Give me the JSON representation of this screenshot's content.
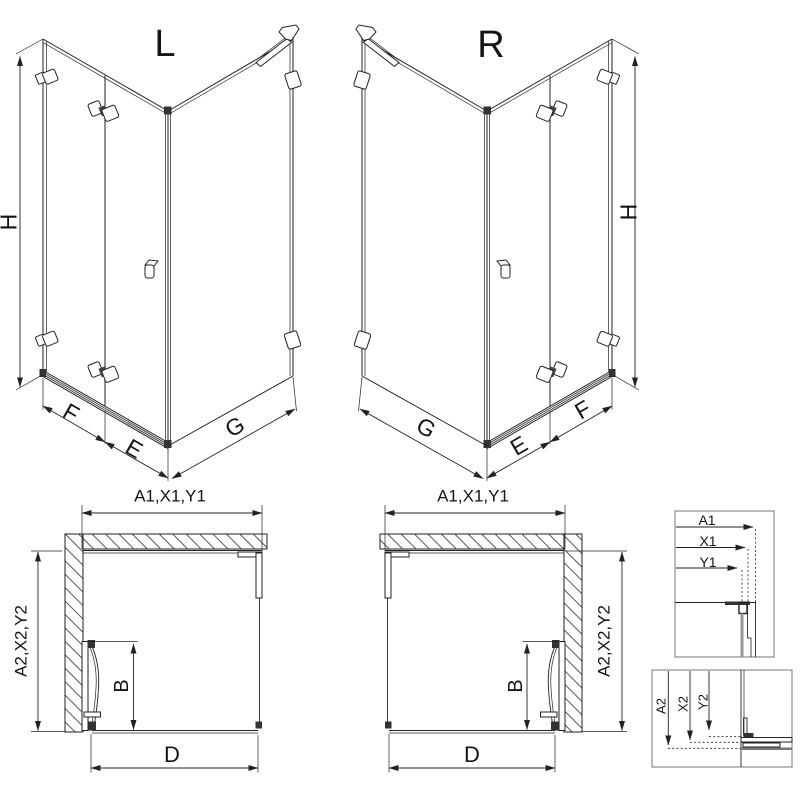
{
  "page": {
    "background": "#ffffff",
    "line_color": "#222222",
    "hatch_color": "#444444"
  },
  "diagrams": {
    "iso_left": {
      "title": "L",
      "height_dim": "H",
      "front_fixed_dim": "F",
      "front_door_dim": "E",
      "side_dim": "G"
    },
    "iso_right": {
      "title": "R",
      "height_dim": "H",
      "front_fixed_dim": "F",
      "front_door_dim": "E",
      "side_dim": "G"
    },
    "plan_left": {
      "width_dims": "A1,X1,Y1",
      "depth_dims": "A2,X2,Y2",
      "door_dim": "B",
      "opening_dim": "D"
    },
    "plan_right": {
      "width_dims": "A1,X1,Y1",
      "depth_dims": "A2,X2,Y2",
      "door_dim": "B",
      "opening_dim": "D"
    },
    "detail_top": {
      "rows": [
        "A1",
        "X1",
        "Y1"
      ]
    },
    "detail_bottom": {
      "rows": [
        "A2",
        "X2",
        "Y2"
      ]
    }
  }
}
